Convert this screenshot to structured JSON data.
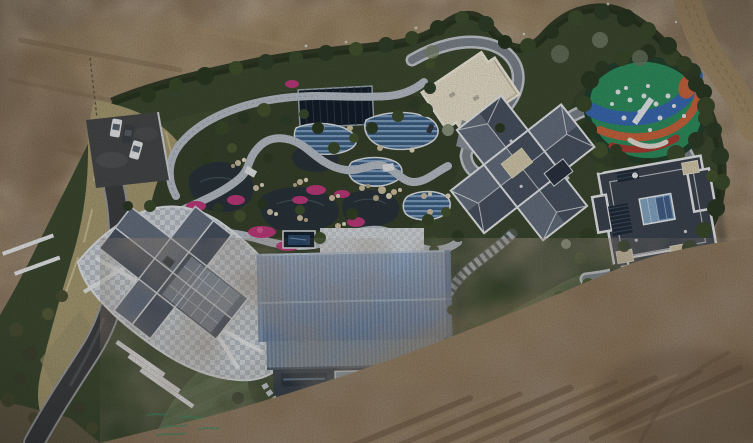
{
  "scene": {
    "setting": "aerial-drone-view-of-landscaped-estate",
    "vehicle_count": 3,
    "vehicle_colors": [
      "white",
      "dark-gray",
      "white"
    ],
    "features": [
      "bare-earth-field",
      "dirt-road",
      "boundary-hedge",
      "parking-area",
      "dry-grass-hill",
      "driveway",
      "ornamental-pond-garden",
      "pink-flower-beds",
      "stone-paths",
      "solar-panel-canopy",
      "pool-terraces",
      "cream-flat-roof-pavilion",
      "colorful-playground",
      "cross-plan-mansion",
      "flat-roof-mansion",
      "gable-roof-house-with-paved-plaza",
      "blue-metal-roof-building",
      "lawn",
      "winding-road",
      "stone-stairway",
      "white-retaining-walls",
      "green-paint-marks"
    ]
  },
  "palette": {
    "dirt_base": "#8b765b",
    "dirt_road": "#a28b69",
    "estate_green": "#3d4a31",
    "hedge_green": "#27331f",
    "grass_dry": "#a79b72",
    "lawn_green": "#4e6040",
    "pond_water": "#2a343b",
    "path_stone": "#b9c0c8",
    "road_asphalt": "#3e3f41",
    "road_edge": "#9a9b9e",
    "road_gray": "#7d858d",
    "road_gray_edge": "#c6cbd0",
    "plaza_pale": "#c7ccd1",
    "flower_pink": "#bf3b7c",
    "rock_tan": "#cfc2a4",
    "navy_panel": "#141e2a",
    "pool_blue_dark": "#3d5f84",
    "pool_blue_light": "#7fa0c0",
    "cream_roof": "#e9e1cb",
    "play_green": "#2f8f5f",
    "play_blue": "#3a6ab2",
    "play_orange": "#c9653e",
    "play_red": "#ab3c32",
    "play_white": "#e8ecef",
    "slate_light": "#66707f",
    "slate_dark": "#4a5362",
    "parapet_white": "#e9ebed",
    "house_dark": "#3d4550",
    "tan_panel": "#d6cbae",
    "glass_blue": "#86a8c6",
    "barn_roof_light": "#97abc6",
    "barn_roof_mid": "#7e94b2",
    "barn_roof_dark": "#667c9b",
    "barn_wall": "#2c3844",
    "window_glass": "#8fa6b8",
    "car_white": "#e8eaec",
    "car_dark": "#3c4045",
    "wall_white": "#e9eaec",
    "mark_green": "#3f8a66"
  }
}
